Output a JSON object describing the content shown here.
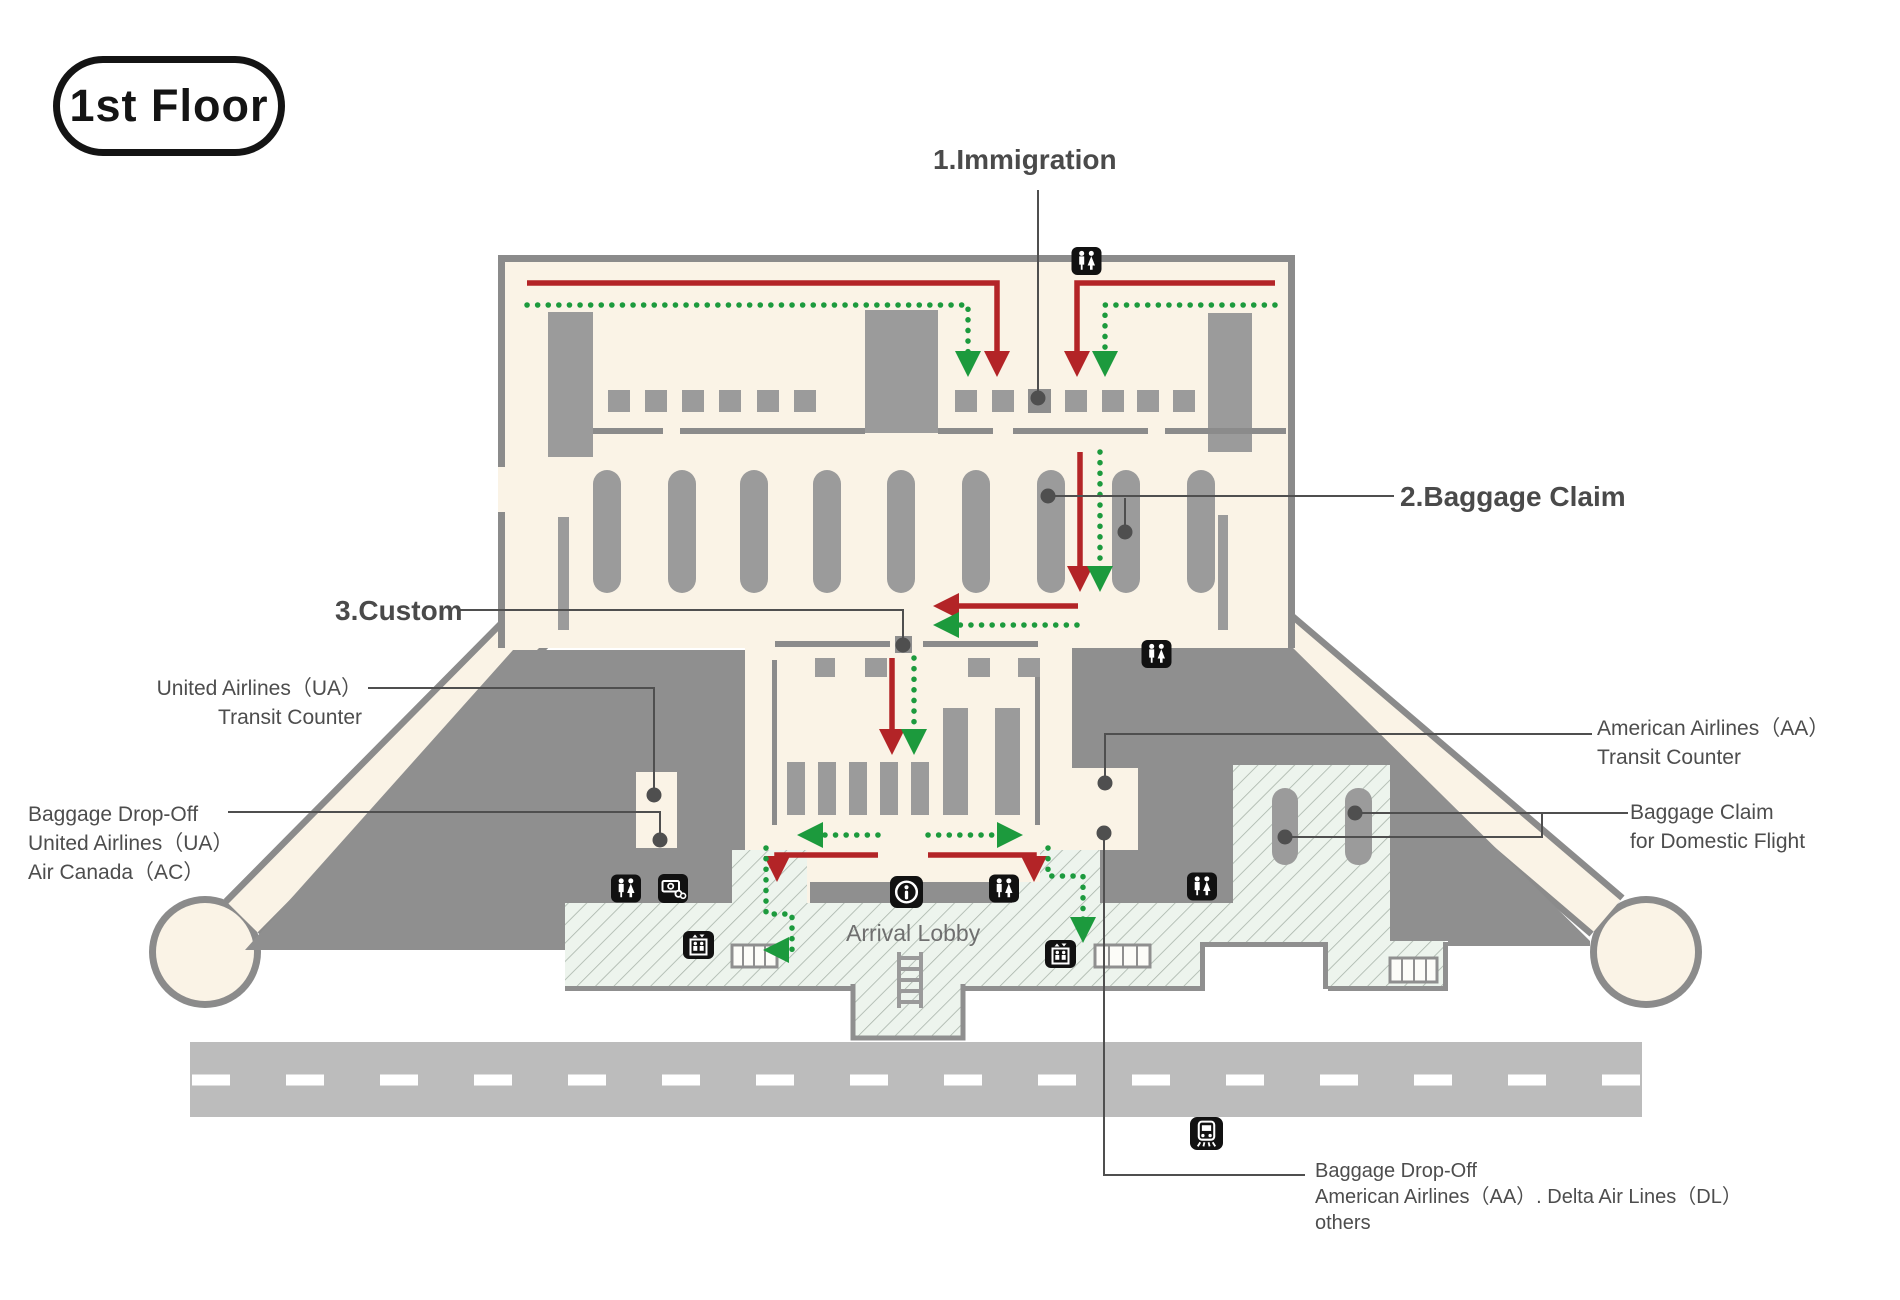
{
  "floor_badge": "1st Floor",
  "callouts": {
    "immigration": "1.Immigration",
    "baggage_claim": "2.Baggage Claim",
    "custom": "3.Custom",
    "ua_transit": {
      "line1": "United Airlines（UA）",
      "line2": "Transit Counter"
    },
    "ua_ac_dropoff": {
      "line1": "Baggage Drop-Off",
      "line2": "United Airlines（UA）",
      "line3": "Air Canada（AC）"
    },
    "aa_transit": {
      "line1": "American Airlines（AA）",
      "line2": "Transit Counter"
    },
    "domestic_baggage": {
      "line1": "Baggage Claim",
      "line2": "for Domestic Flight"
    },
    "aa_dl_dropoff": {
      "line1": "Baggage Drop-Off",
      "line2": "American Airlines（AA）. Delta Air Lines（DL）",
      "line3": "others"
    }
  },
  "areas": {
    "arrival_lobby": "Arrival Lobby"
  },
  "icons": [
    "restroom-icon",
    "currency-exchange-icon",
    "information-icon",
    "elevator-icon",
    "train-icon",
    "moving-walkway",
    "stairs"
  ],
  "colors": {
    "building_fill": "#faf3e6",
    "wall": "#8b8b8b",
    "fixture": "#9b9b9b",
    "tarmac": "#8f8f8f",
    "hatch_fill": "#edf4ed",
    "hatch_line": "#a9b4aa",
    "road": "#bcbcbc",
    "route_red": "#b32427",
    "route_green": "#1c9a3d",
    "leader": "#4f4f4f",
    "label_text": "#4d4d4d",
    "icon_bg": "#111111"
  }
}
